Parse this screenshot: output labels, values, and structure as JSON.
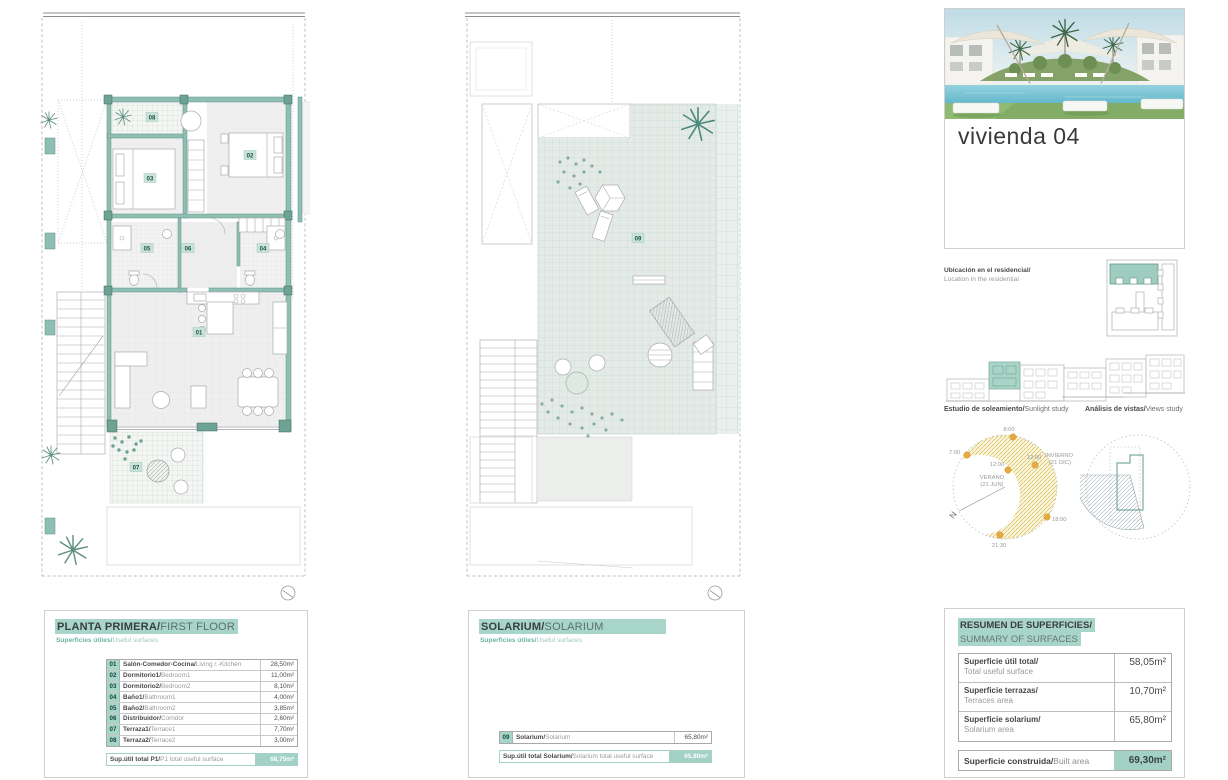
{
  "floor_panel": {
    "title_es": "PLANTA PRIMERA/",
    "title_en": "FIRST FLOOR",
    "subtitle_es": "Superficies útiles/",
    "subtitle_en": "Useful surfaces",
    "rows": [
      {
        "num": "01",
        "es": "Salón-Comedor-Cocina/",
        "en": "Living r.-Kitchen",
        "value": "28,50m²"
      },
      {
        "num": "02",
        "es": "Dormitorio1/",
        "en": "Bedroom1",
        "value": "11,00m²"
      },
      {
        "num": "03",
        "es": "Dormitorio2/",
        "en": "Bedroom2",
        "value": "8,10m²"
      },
      {
        "num": "04",
        "es": "Baño1/",
        "en": "Bathroom1",
        "value": "4,00m²"
      },
      {
        "num": "05",
        "es": "Baño2/",
        "en": "Bathroom2",
        "value": "3,85m²"
      },
      {
        "num": "06",
        "es": "Distribuidor/",
        "en": "Corridor",
        "value": "2,60m²"
      },
      {
        "num": "07",
        "es": "Terraza1/",
        "en": "Terrace1",
        "value": "7,70m²"
      },
      {
        "num": "08",
        "es": "Terraza2/",
        "en": "Terrace2",
        "value": "3,00m²"
      }
    ],
    "total_es": "Sup.útil total P1/",
    "total_en": "P1 total useful surface",
    "total_value": "68,75m²",
    "room_labels": {
      "r01": "01",
      "r02": "02",
      "r03": "03",
      "r04": "04",
      "r05": "05",
      "r06": "06",
      "r07": "07",
      "r08": "08"
    }
  },
  "solarium_panel": {
    "title_es": "SOLARIUM/",
    "title_en": "SOLARIUM",
    "subtitle_es": "Superficies útiles/",
    "subtitle_en": "Useful surfaces",
    "row": {
      "num": "09",
      "es": "Solarium/",
      "en": "Solarium",
      "value": "65,80m²"
    },
    "total_es": "Sup.útil total Solarium/",
    "total_en": "Solarium total useful surface",
    "total_value": "65,80m²",
    "room_label": "09"
  },
  "right_panel": {
    "unit_title": "vivienda 04",
    "location_es": "Ubicación en el residencial/",
    "location_en": "Location in the residential",
    "sunlight_es": "Estudio de soleamiento/",
    "sunlight_en": "Sunlight study",
    "views_es": "Análisis de vistas/",
    "views_en": "Views study",
    "sun_diagram": {
      "t_800": "8:00",
      "t_700": "7:00",
      "t_1200_summer": "12:00",
      "t_1200_winter": "12:00",
      "t_1800": "18:00",
      "t_2130": "21:30",
      "summer_1": "VERANO",
      "summer_2": "(21 JUN)",
      "winter_1": "INVIERNO",
      "winter_2": "(21 DIC)",
      "north": "N"
    },
    "summary": {
      "title_es": "RESUMEN DE SUPERFICIES/",
      "title_en": "SUMMARY OF SURFACES",
      "rows": [
        {
          "es": "Superficie útil total/",
          "en": "Total useful surface",
          "value": "58,05m²"
        },
        {
          "es": "Superficie terrazas/",
          "en": "Terraces area",
          "value": "10,70m²"
        },
        {
          "es": "Superficie solarium/",
          "en": "Solarium area",
          "value": "65,80m²"
        }
      ],
      "total_es": "Superficie construida/",
      "total_en": "Built area",
      "total_value": "69,30m²"
    }
  }
}
